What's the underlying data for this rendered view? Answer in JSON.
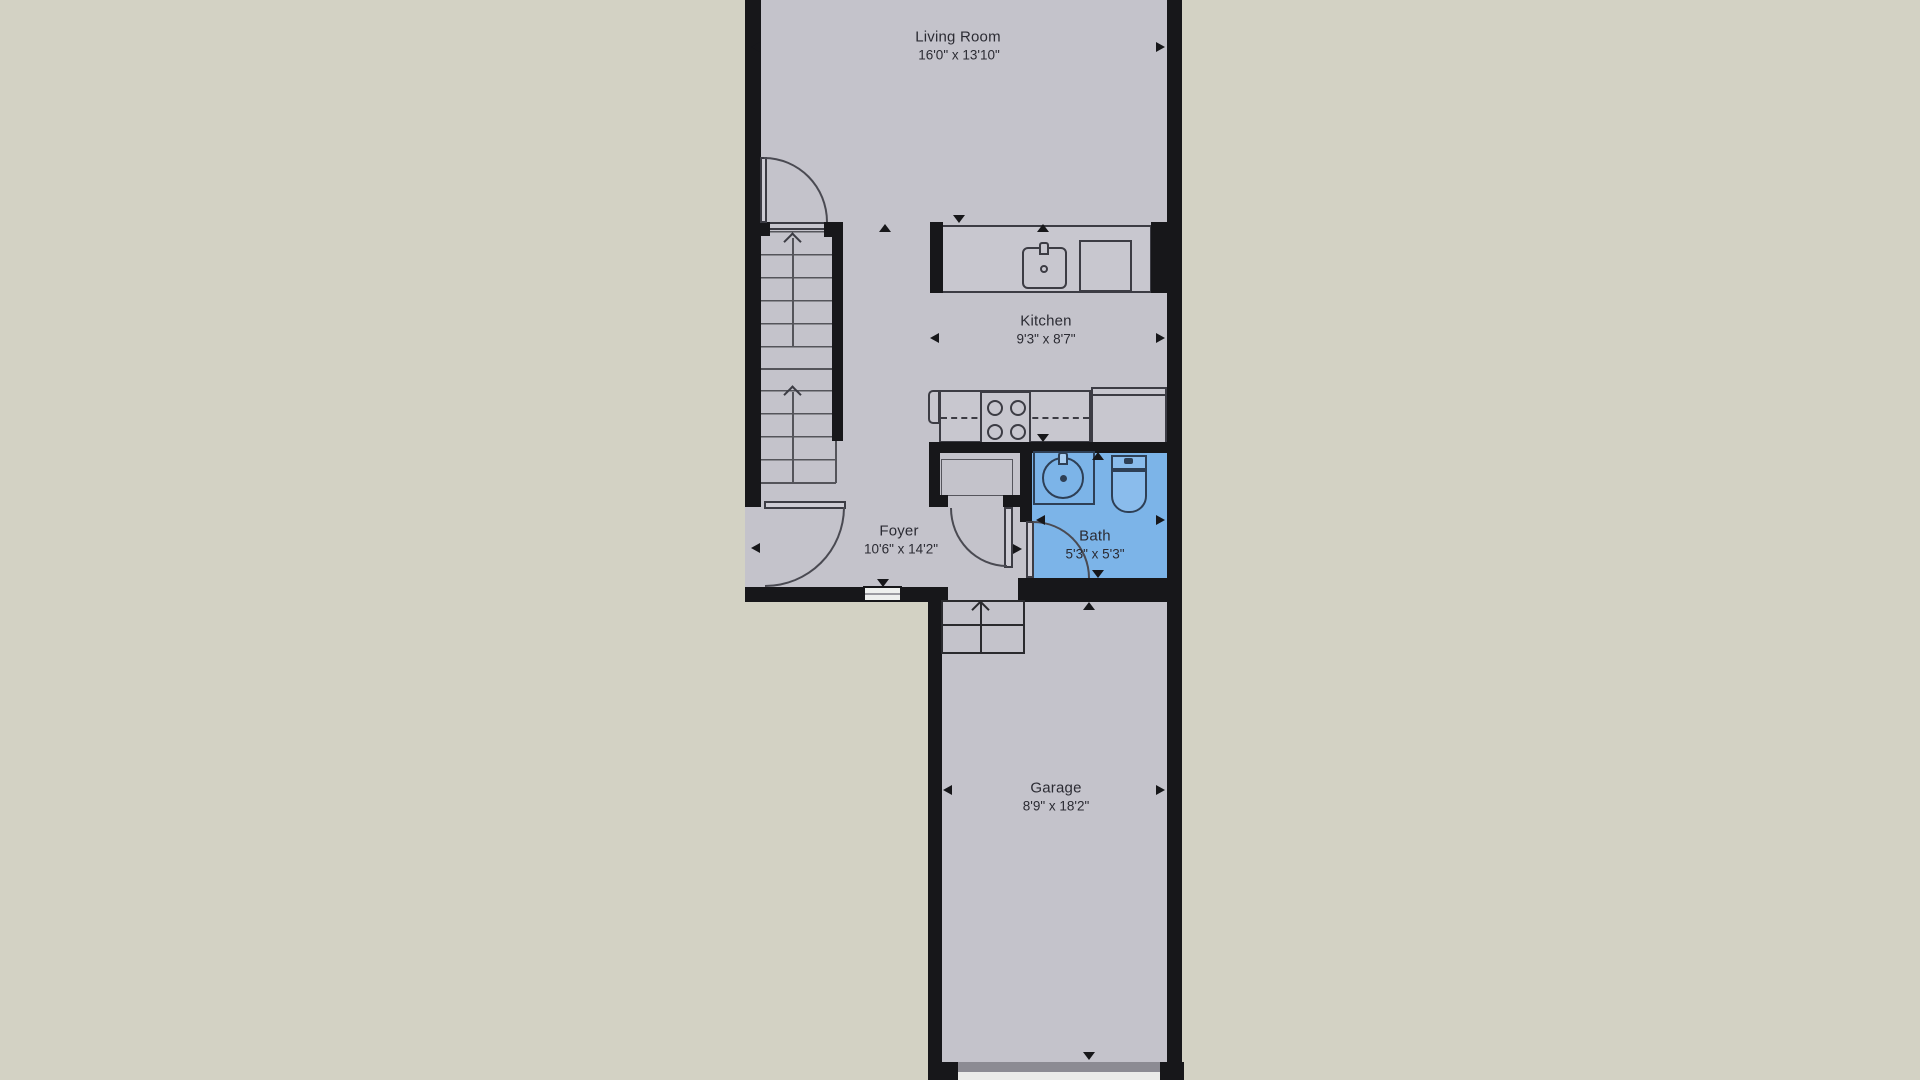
{
  "plan": {
    "title": "Townhouse first-floor plan",
    "rooms": {
      "living_room": {
        "name": "Living Room",
        "dimensions": "16'0\" x 13'10\""
      },
      "kitchen": {
        "name": "Kitchen",
        "dimensions": "9'3\" x 8'7\""
      },
      "foyer": {
        "name": "Foyer",
        "dimensions": "10'6\" x 14'2\""
      },
      "bath": {
        "name": "Bath",
        "dimensions": "5'3\" x 5'3\""
      },
      "garage": {
        "name": "Garage",
        "dimensions": "8'9\" x 18'2\""
      }
    },
    "colors": {
      "background": "#d3d2c4",
      "floor": "#c4c3cb",
      "wall": "#17171a",
      "bath_floor": "#7cb4e8",
      "fixture_outline": "#3c3c44",
      "bath_fixture_outline": "#2e3f55",
      "text": "#2b2b33"
    }
  }
}
